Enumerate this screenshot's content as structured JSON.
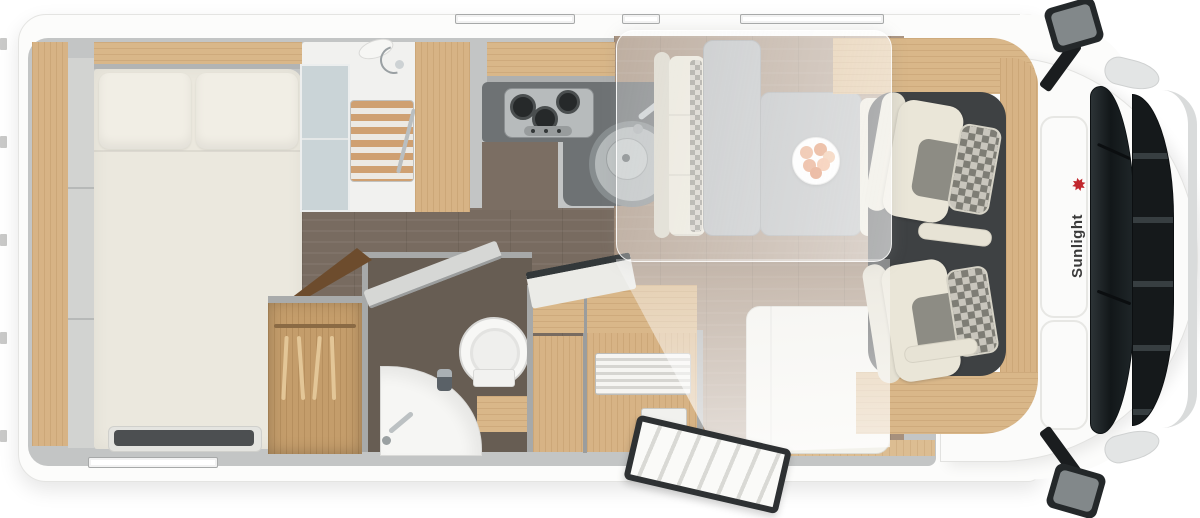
{
  "image_type": "motorhome-floor-plan-top-view",
  "brand": {
    "label": "Sunlight",
    "logo_icon": "red-palm-star-icon",
    "logo_icon_glyph": "✸",
    "text_color": "#3a3a3a",
    "accent_color": "#c1272d"
  },
  "areas": {
    "rear_bed": {
      "name": "rear transverse bed",
      "items": [
        "mattress",
        "pillow-left",
        "pillow-right",
        "overhead-locker",
        "foot-mat"
      ]
    },
    "shower": {
      "name": "shower cubicle",
      "items": [
        "shower-head",
        "wooden-duckboard",
        "glass-partition",
        "towel-bar"
      ]
    },
    "kitchen": {
      "name": "kitchen block",
      "items": [
        "three-burner-hob",
        "round-sink",
        "faucet",
        "worktop",
        "overhead-locker",
        "tall-cupboard"
      ]
    },
    "washroom": {
      "name": "washroom",
      "items": [
        "toilet",
        "corner-basin",
        "basin-faucet",
        "soap-dispenser",
        "open-door"
      ]
    },
    "wardrobe": {
      "name": "wardrobe",
      "items": [
        "hanging-rail",
        "clothes-hangers"
      ]
    },
    "dinette": {
      "name": "half-dinette",
      "items": [
        "bench-seat",
        "table-panels",
        "fruit-plate",
        "side-sofa"
      ]
    },
    "drop_down_bed": {
      "name": "drop-down bed overlay (translucent)"
    },
    "entrance": {
      "name": "entrance door open",
      "items": [
        "entry-step",
        "wood-threshold",
        "door-leaf"
      ]
    },
    "cab": {
      "name": "driver cab",
      "items": [
        "driver-seat",
        "passenger-seat",
        "checkered-headrests",
        "armrests",
        "cab-floor"
      ]
    },
    "vehicle_front": {
      "name": "cab front exterior",
      "items": [
        "windshield",
        "wipers",
        "grille",
        "chrome-trim",
        "headlights",
        "mirror-top",
        "mirror-bottom",
        "roof-skylights"
      ]
    }
  },
  "storage": {
    "cabinet_items": [
      "top-locker-open-lid",
      "tambour-roller-door",
      "lower-cabinets"
    ]
  },
  "windows": {
    "top_wall_strips": 3,
    "bottom_wall_strips": 1
  },
  "colors": {
    "body_white": "#fcfcfb",
    "wall_gray": "#c3c5c5",
    "wood_light": "#d9b789",
    "wood_dark": "#6d4c2d",
    "floor_corridor": "#786b60",
    "floor_dinette": "#a6907d",
    "cab_floor": "#3e4143",
    "counter_gray": "#6e7274",
    "mattress_cream": "#ebe8de",
    "seat_cream": "#eae6d8",
    "accent_red": "#c1272d"
  }
}
